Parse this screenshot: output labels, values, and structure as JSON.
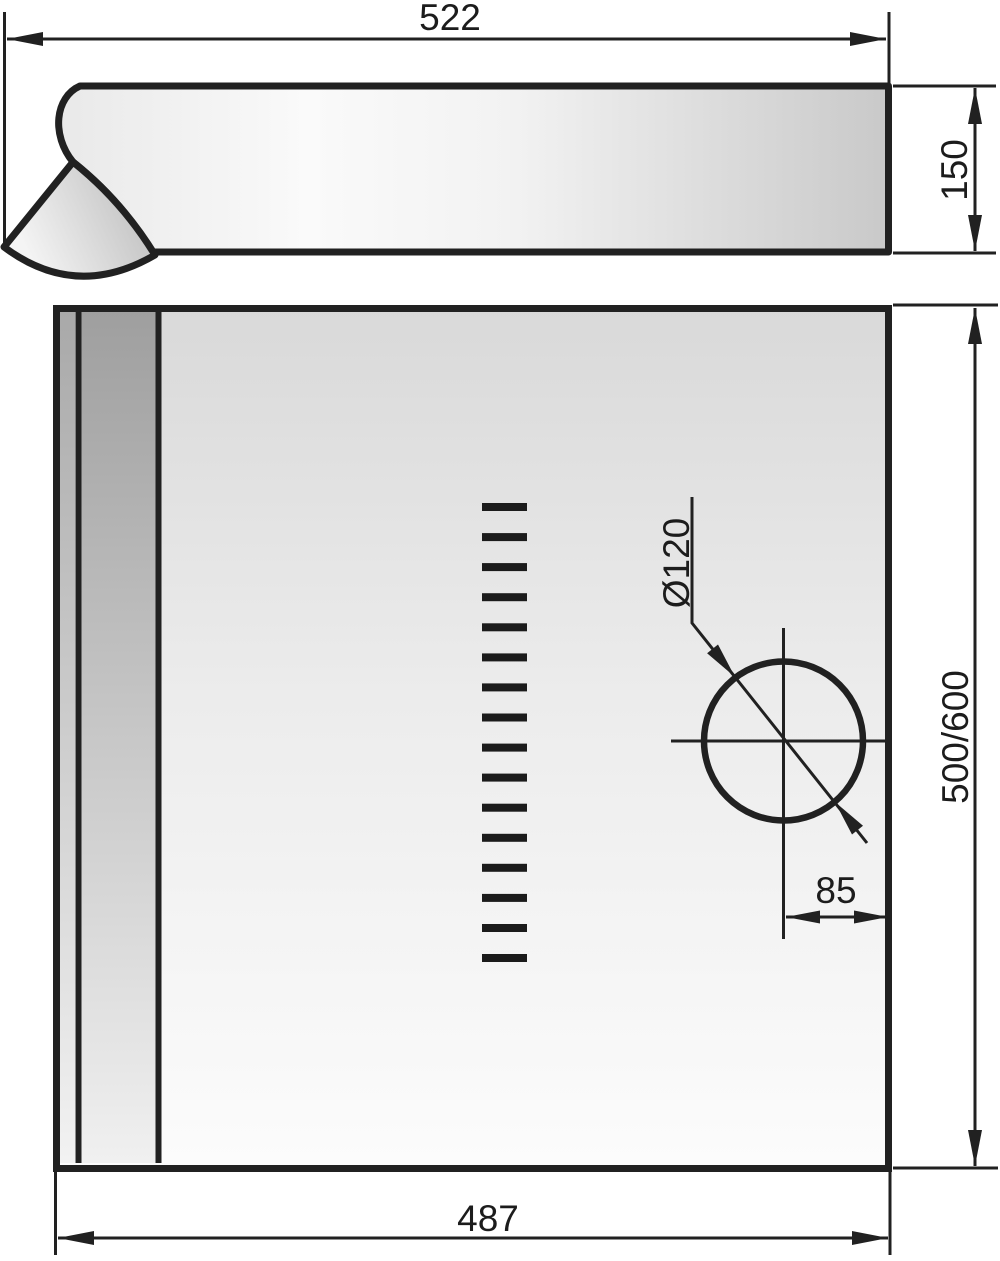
{
  "drawing": {
    "kind": "cooker-hood installation drawing",
    "views": {
      "side_view_label": "side profile",
      "front_view_label": "front panel"
    }
  },
  "dimensions": {
    "overall_width": "522",
    "body_depth": "150",
    "duct_diameter": "Ø120",
    "duct_offset_right": "85",
    "body_height": "500/600",
    "bottom_width": "487"
  },
  "vent_slots": {
    "count": 16
  },
  "colors": {
    "line": "#212121",
    "text": "#1c1c1c",
    "background": "#ffffff",
    "slot_fill": "#1b1b1b"
  }
}
